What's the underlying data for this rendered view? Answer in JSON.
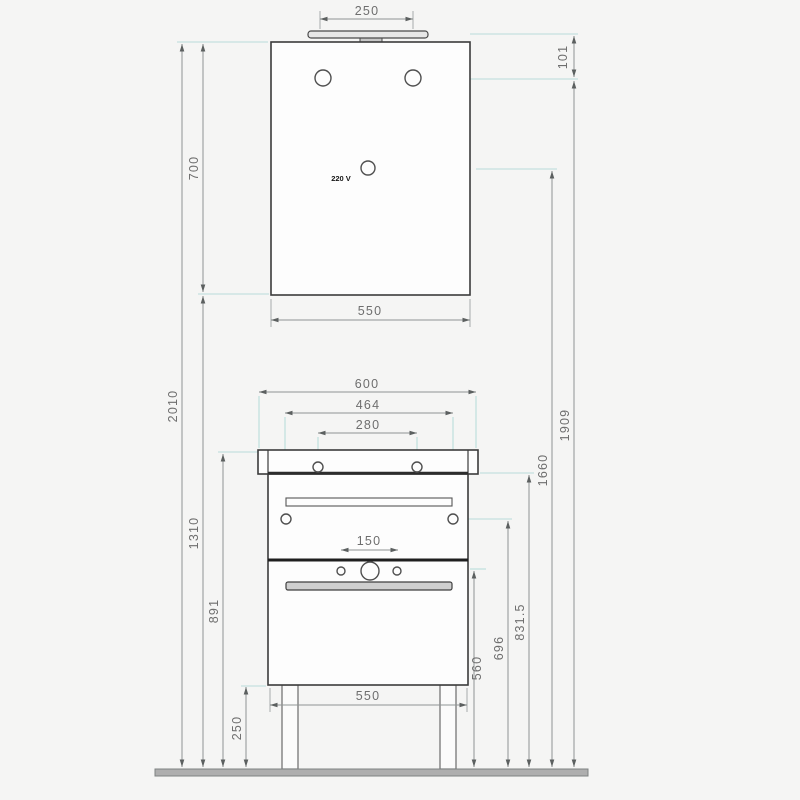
{
  "drawing": {
    "type": "technical-dimension-drawing",
    "subject": "bathroom furniture set: illuminated mirror above washbasin vanity cabinet, front elevation with dimensions in mm",
    "labels": {
      "socket_label": "220 V"
    },
    "dimensions": {
      "lamp_width": "250",
      "lamp_offset": "101",
      "mirror_height": "700",
      "total_height": "2010",
      "mirror_bottom_clearance": "1310",
      "mirror_width": "550",
      "washbasin_width": "600",
      "rear_holes_spacing": "464",
      "faucet_holes_spacing": "280",
      "holes_level_height": "1909",
      "socket_height": "1660",
      "drawer_holes_spacing": "150",
      "worktop_height": "891",
      "basin_rim_height": "831.5",
      "side_holes_height": "696",
      "lower_holes_height": "560",
      "cabinet_width": "550",
      "legs_height": "250"
    },
    "units": "mm",
    "colors": {
      "furniture_line": "#3b3b3b",
      "dimension_line": "#8f9494",
      "extension_line": "#b9dcda",
      "text": "#6e6e6e",
      "floor": "#aeaeae",
      "background": "#f5f5f4"
    }
  }
}
